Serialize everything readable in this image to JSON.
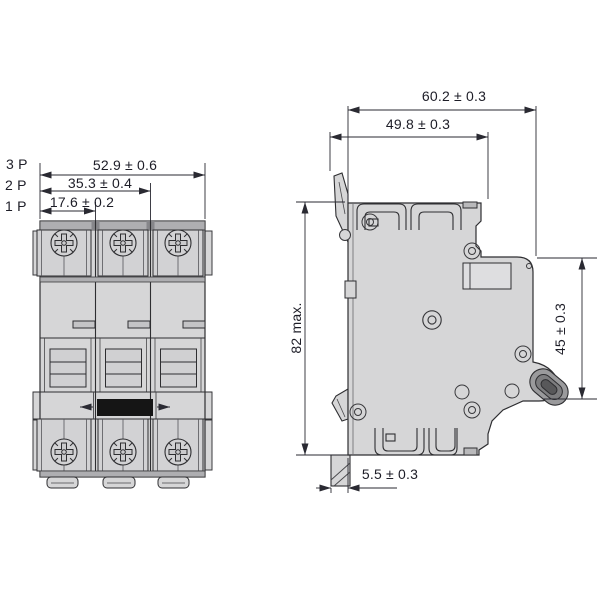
{
  "front_view": {
    "pole_3": "3 P",
    "pole_2": "2 P",
    "pole_1": "1 P",
    "dim_width_3p": "52.9 ± 0.6",
    "dim_width_2p": "35.3 ± 0.4",
    "dim_width_1p": "17.6 ± 0.2"
  },
  "side_view": {
    "dim_depth_total": "60.2 ± 0.3",
    "dim_depth_body": "49.8 ± 0.3",
    "dim_height_max": "82 max.",
    "dim_front_height": "45 ± 0.3",
    "dim_rail_offset": "5.5 ± 0.3"
  },
  "icons": {
    "terminal_screw": "phillips-screw-icon",
    "rivet": "rivet-icon",
    "toggle": "toggle-lever-icon",
    "din_foot": "din-clip-foot"
  },
  "colors": {
    "background": "#ffffff",
    "body_fill": "#d6d6d7",
    "shade_band": "#aeaeb1",
    "dark_notch": "#86868a",
    "handle_black": "#151515",
    "outline": "#2e2e31",
    "dimension": "#2a2a32",
    "text": "#1d1d27"
  }
}
